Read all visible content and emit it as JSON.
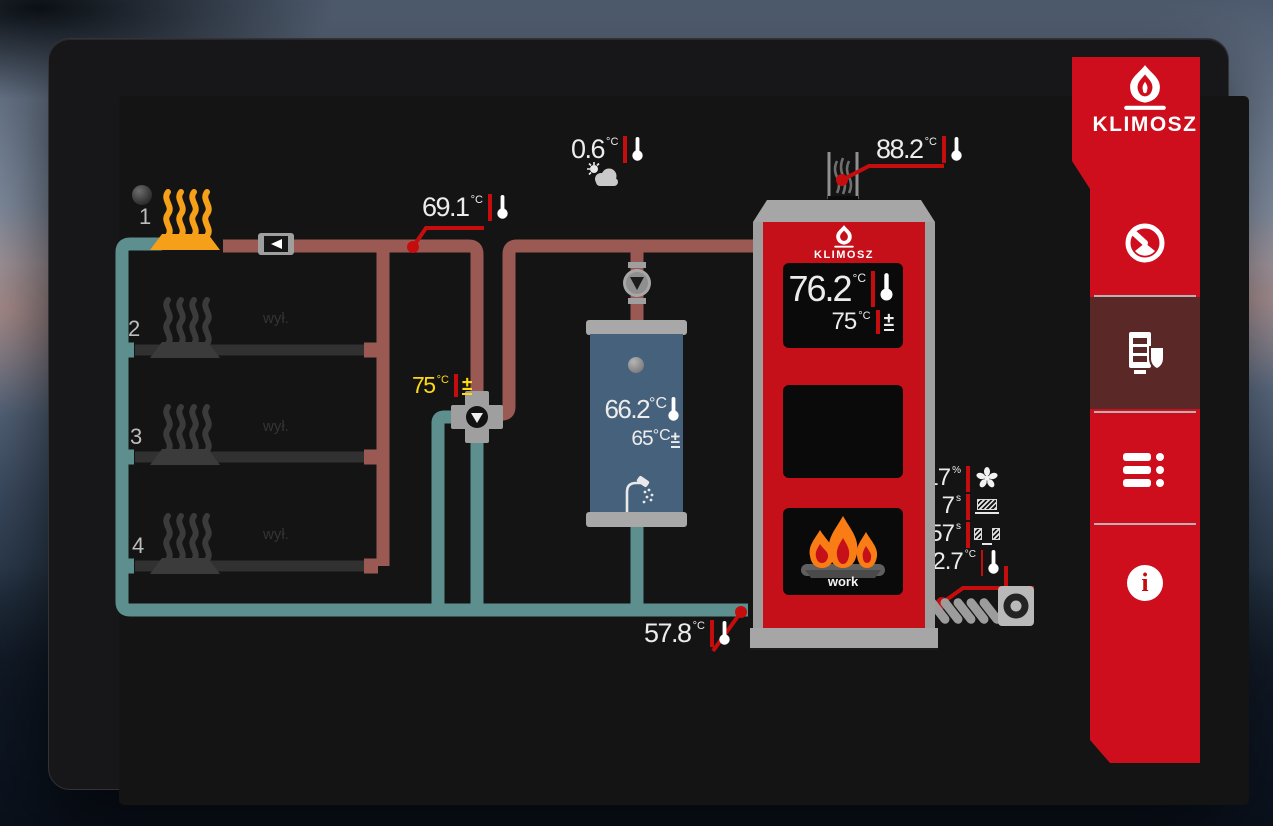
{
  "app": {
    "brand": "KLIMOSZ"
  },
  "sidebar": {
    "logo_text": "KLIMOSZ",
    "items": [
      {
        "id": "dashboard",
        "icon": "gauge-icon",
        "selected": false
      },
      {
        "id": "boiler",
        "icon": "boiler-icon",
        "selected": true
      },
      {
        "id": "menu",
        "icon": "list-icon",
        "selected": false
      },
      {
        "id": "info",
        "icon": "info-icon",
        "selected": false
      }
    ]
  },
  "sensors": {
    "outdoor": {
      "value": "0.6",
      "unit": "°C"
    },
    "heating_supply": {
      "value": "69.1",
      "unit": "°C"
    },
    "flue": {
      "value": "88.2",
      "unit": "°C"
    },
    "return": {
      "value": "57.8",
      "unit": "°C"
    },
    "mixer_setpoint": {
      "value": "75",
      "unit": "°C"
    },
    "fan": {
      "value": "17",
      "unit": "%"
    },
    "feeder_work": {
      "value": "7",
      "unit": "s"
    },
    "feeder_pause": {
      "value": "57",
      "unit": "s"
    },
    "feeder_temp": {
      "value": "32.7",
      "unit": "°C"
    }
  },
  "boiler": {
    "brand": "KLIMOSZ",
    "temp": {
      "value": "76.2",
      "unit": "°C"
    },
    "setpoint": {
      "value": "75",
      "unit": "°C"
    },
    "status": "work"
  },
  "tank": {
    "temp": {
      "value": "66.2",
      "unit": "°C"
    },
    "setpoint": {
      "value": "65",
      "unit": "°C"
    }
  },
  "circuits": {
    "off_label": "wył.",
    "radiators": [
      {
        "number": "1",
        "state": "on"
      },
      {
        "number": "2",
        "state": "off"
      },
      {
        "number": "3",
        "state": "off"
      },
      {
        "number": "4",
        "state": "off"
      }
    ]
  },
  "colors": {
    "brand_red": "#ce0d1d",
    "accent_red": "#c60d0d",
    "supply_pipe": "#9a5a53",
    "return_pipe": "#5c8f8e",
    "active_orange": "#f5a018",
    "setpoint_yellow": "#ffd911",
    "selected_item": "#5a2826"
  }
}
